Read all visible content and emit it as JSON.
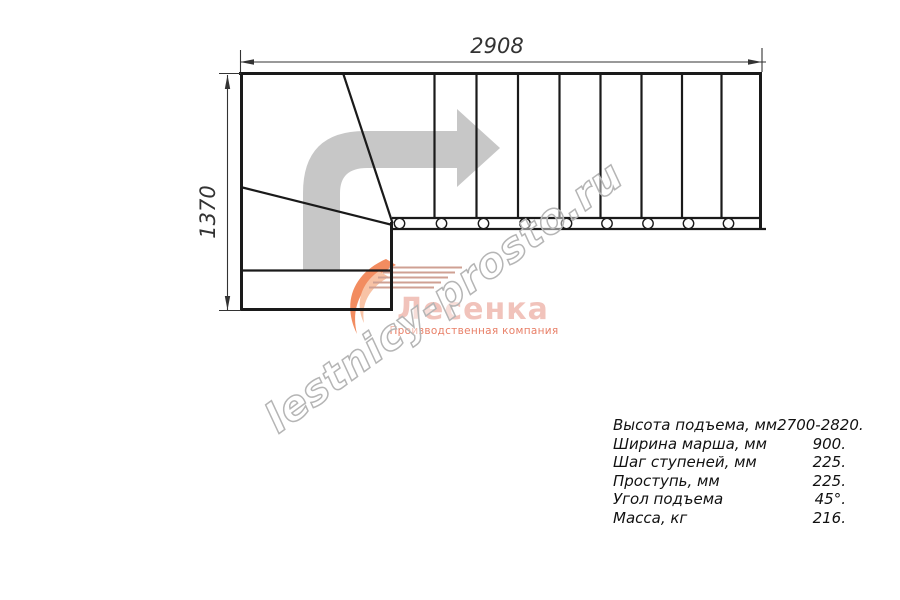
{
  "dimensions": {
    "width_mm": "2908",
    "height_mm": "1370"
  },
  "watermark": {
    "text": "lestnicy-prosto.ru"
  },
  "logo": {
    "name": "Лесенка",
    "subtitle": "Производственная компания"
  },
  "specs": {
    "rows": [
      {
        "label": "Высота подъема, мм",
        "value": "2700-2820."
      },
      {
        "label": "Ширина марша, мм",
        "value": "900."
      },
      {
        "label": "Шаг ступеней, мм",
        "value": "225."
      },
      {
        "label": "Проступь, мм",
        "value": "225."
      },
      {
        "label": "Угол подъема",
        "value": "45°."
      },
      {
        "label": "Масса, кг",
        "value": "216."
      }
    ]
  },
  "colors": {
    "line": "#1a1a1a",
    "dim": "#333333",
    "arrow": "#c7c7c7",
    "wm": "#b5b5b5",
    "logo-text": "#f1c3bb",
    "logo-sub": "#e87f67",
    "swoosh": "#f28c60",
    "swoosh-light": "#f8c3a6",
    "speed": "#cfa093",
    "bg": "#ffffff"
  }
}
